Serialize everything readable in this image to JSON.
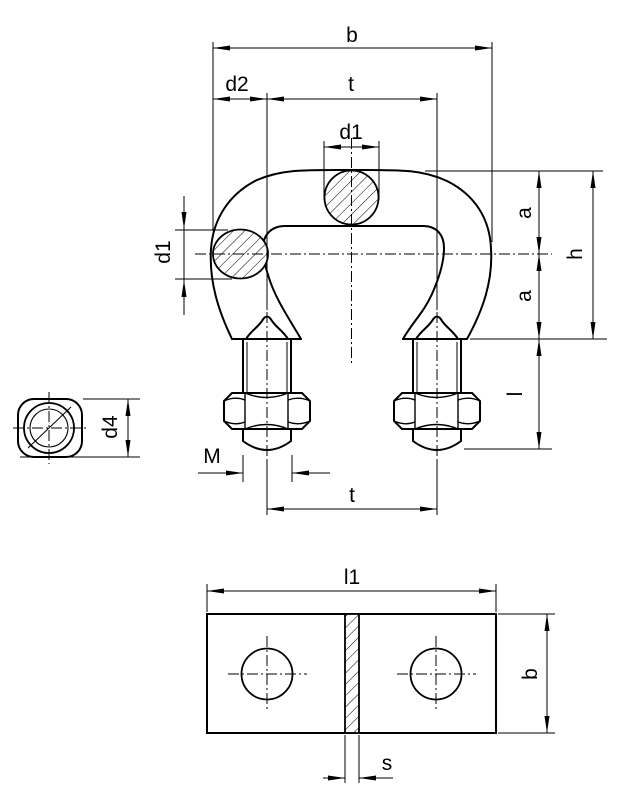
{
  "drawing": {
    "type": "technical dimension drawing of a wire rope clamp (stirrup with two rope cross-sections, two threaded legs with hex nuts, end view of bolt, top view of clamp plate)"
  },
  "front_view": {
    "dim_b": "b",
    "dim_d2": "d2",
    "dim_t_top": "t",
    "dim_d1_top": "d1",
    "dim_d1_side": "d1",
    "dim_a_upper": "a",
    "dim_h": "h",
    "dim_a_lower": "a",
    "dim_l": "l",
    "dim_thread": "M",
    "dim_t_bottom": "t"
  },
  "end_view": {
    "dim_d4": "d4"
  },
  "top_view": {
    "dim_l1": "l1",
    "dim_b": "b",
    "dim_s": "s"
  },
  "colors": {
    "line": "#000000",
    "background": "#ffffff"
  }
}
